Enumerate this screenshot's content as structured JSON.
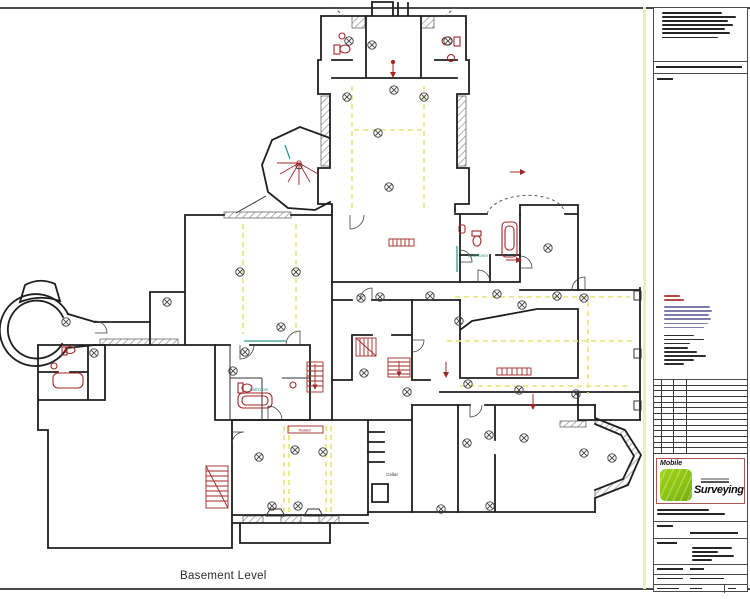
{
  "sheet": {
    "level_label": "Basement Level"
  },
  "plan": {
    "room_labels": [
      {
        "text": "Bathroom",
        "x": 478,
        "y": 257,
        "size": 4.6,
        "color": "teal"
      },
      {
        "text": "Bathroom",
        "x": 259,
        "y": 391,
        "size": 4.2,
        "color": "teal"
      },
      {
        "text": "Cellar",
        "x": 392,
        "y": 476,
        "size": 4.6,
        "color": "dark"
      },
      {
        "text": "Radiator",
        "x": 305,
        "y": 431.5,
        "size": 3.4,
        "color": "red"
      }
    ],
    "lights": [
      [
        349,
        41
      ],
      [
        448,
        41
      ],
      [
        372,
        45
      ],
      [
        394,
        90
      ],
      [
        347,
        97
      ],
      [
        424,
        97
      ],
      [
        378,
        133
      ],
      [
        389,
        187
      ],
      [
        167,
        302
      ],
      [
        240,
        272
      ],
      [
        296,
        272
      ],
      [
        281,
        327
      ],
      [
        245,
        352
      ],
      [
        233,
        371
      ],
      [
        361,
        298
      ],
      [
        380,
        297
      ],
      [
        430,
        296
      ],
      [
        459,
        321
      ],
      [
        497,
        294
      ],
      [
        522,
        305
      ],
      [
        548,
        248
      ],
      [
        557,
        296
      ],
      [
        584,
        298
      ],
      [
        66,
        322
      ],
      [
        94,
        353
      ],
      [
        364,
        373
      ],
      [
        407,
        392
      ],
      [
        468,
        384
      ],
      [
        519,
        390
      ],
      [
        576,
        394
      ],
      [
        612,
        458
      ],
      [
        584,
        453
      ],
      [
        524,
        438
      ],
      [
        489,
        435
      ],
      [
        467,
        443
      ],
      [
        295,
        450
      ],
      [
        259,
        457
      ],
      [
        323,
        452
      ],
      [
        272,
        506
      ],
      [
        298,
        506
      ],
      [
        441,
        509
      ],
      [
        490,
        506
      ]
    ],
    "guides": [
      [
        352,
        86,
        352,
        210
      ],
      [
        424,
        86,
        424,
        210
      ],
      [
        354,
        130,
        422,
        130
      ],
      [
        243,
        224,
        243,
        334
      ],
      [
        296,
        224,
        296,
        334
      ],
      [
        455,
        297,
        630,
        297
      ],
      [
        447,
        341,
        634,
        341
      ],
      [
        460,
        386,
        627,
        386
      ],
      [
        588,
        302,
        588,
        394
      ],
      [
        284,
        426,
        284,
        512
      ],
      [
        289,
        426,
        289,
        512
      ],
      [
        326,
        426,
        326,
        512
      ],
      [
        331,
        426,
        331,
        512
      ]
    ]
  },
  "title_block": {
    "notes_lines": [
      60,
      74,
      66,
      71,
      63,
      68,
      56
    ],
    "band_line_w": 86,
    "tag_w": 16,
    "legend": {
      "red": [
        16,
        20
      ],
      "blue": [
        46,
        48,
        45,
        47,
        44,
        40
      ],
      "black": [
        30,
        40,
        26,
        24,
        33,
        42,
        30,
        20
      ]
    },
    "revision_table": {
      "rows": 13,
      "col_x": [
        7,
        19,
        32
      ]
    },
    "logo": {
      "brand_top": "Mobile",
      "brand_main": "Surveying",
      "trademark": "™"
    },
    "after_logo_lines": [
      52,
      68
    ],
    "doc_label_w": 16,
    "doc_line_w": 48,
    "client_label_w": 20,
    "client_lines": [
      40,
      26,
      42,
      20
    ],
    "footer_rows": [
      [
        26,
        14
      ],
      [
        26,
        34
      ],
      [
        22,
        12,
        8
      ]
    ]
  },
  "colors": {
    "tb-border": "#4a4a4a",
    "greek": "#262626",
    "margin-yellow": "#ededc0",
    "yellow": "#e6e67c",
    "line": "#1f1f1f",
    "hatch": "#9c9c9c",
    "red": "#a32626",
    "dark-red": "#8c1f1f",
    "teal": "#2e9c8e",
    "legend-red": "#b04848",
    "legend-blue": "#7d7dac",
    "logo-green": "#8cc312",
    "logo-border": "#b05454"
  }
}
